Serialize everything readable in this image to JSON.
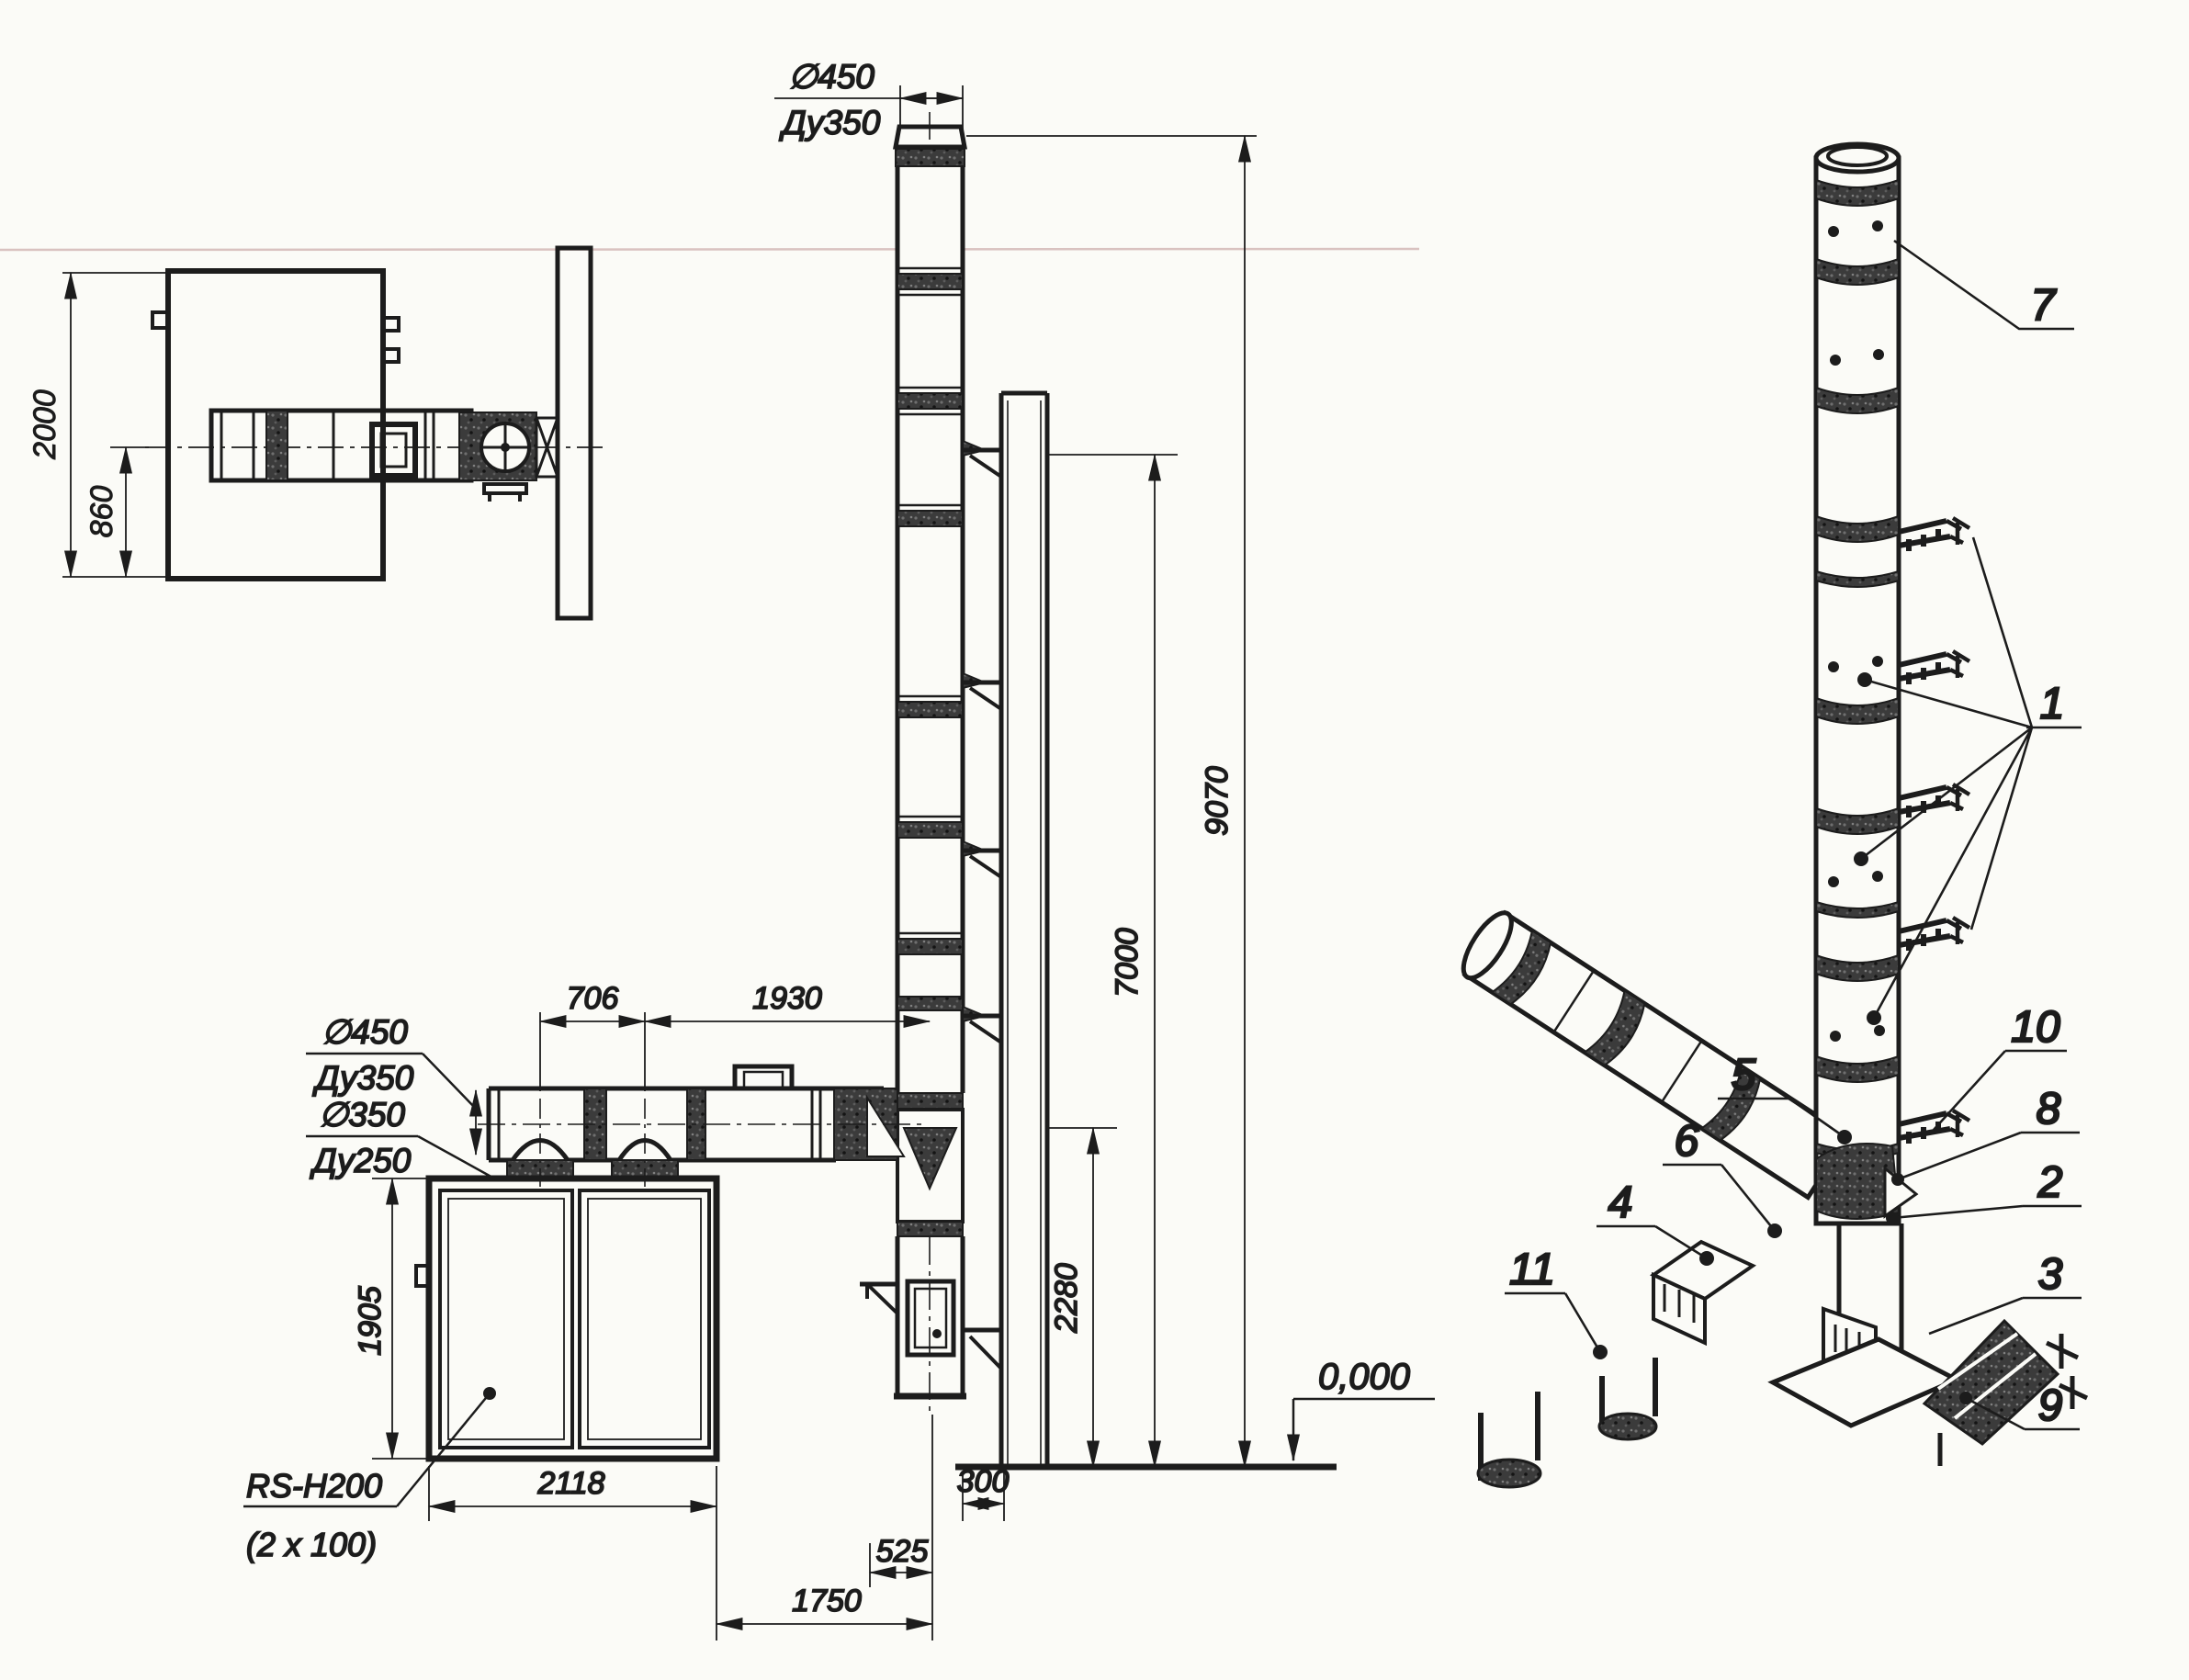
{
  "drawing": {
    "plan": {
      "dim_2000": "2000",
      "dim_860": "860"
    },
    "elevation": {
      "top_dia": {
        "d": "∅450",
        "du": "Ду350"
      },
      "duct_dia": {
        "d": "∅450",
        "du": "Ду350"
      },
      "branch_dia": {
        "d": "∅350",
        "du": "Ду250"
      },
      "dim_706": "706",
      "dim_1930": "1930",
      "dim_1905": "1905",
      "dim_2280": "2280",
      "dim_7000": "7000",
      "dim_9070": "9070",
      "level_zero": "0,000",
      "dim_2118": "2118",
      "dim_300": "300",
      "dim_525": "525",
      "dim_1750": "1750",
      "boiler": {
        "model": "RS-H200",
        "config": "(2 x 100)"
      }
    },
    "isometric": {
      "callouts": {
        "c1": "1",
        "c2": "2",
        "c3": "3",
        "c4": "4",
        "c5": "5",
        "c6": "6",
        "c7": "7",
        "c8": "8",
        "c9": "9",
        "c10": "10",
        "c11": "11"
      }
    },
    "colors": {
      "ink": "#1c1c1c",
      "paper": "#fbfbf7"
    }
  }
}
